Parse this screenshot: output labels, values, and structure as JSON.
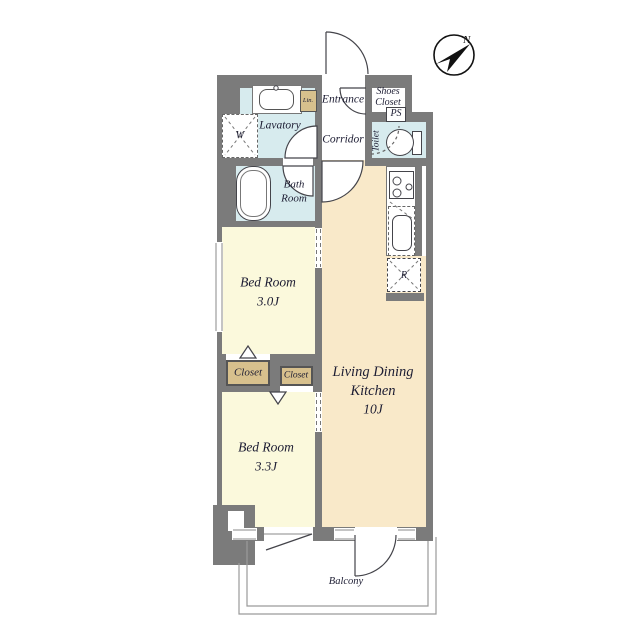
{
  "colors": {
    "paper": "#ffffff",
    "wall": "#7b7b7b",
    "line": "#44444a",
    "thin-line": "#999999",
    "water-room": "#d7ebee",
    "ldk-room": "#f9e9c9",
    "bedroom": "#fbf9dc",
    "closet": "#d7c08d",
    "label": "#1d1d33"
  },
  "labels": {
    "entrance": "Entrance",
    "shoes1": "Shoes",
    "shoes2": "Closet",
    "ps": "PS",
    "corridor": "Corridor",
    "toilet": "Toilet",
    "lavatory": "Lavatory",
    "linen": "Lin.",
    "washer": "W",
    "bath1": "Bath",
    "bath2": "Room",
    "bed1_name": "Bed Room",
    "bed1_size": "3.0J",
    "closet_left": "Closet",
    "closet_right": "Closet",
    "bed2_name": "Bed Room",
    "bed2_size": "3.3J",
    "ldk1": "Living Dining",
    "ldk2": "Kitchen",
    "ldk3": "10J",
    "balcony": "Balcony",
    "fridge": "R",
    "north": "N"
  }
}
